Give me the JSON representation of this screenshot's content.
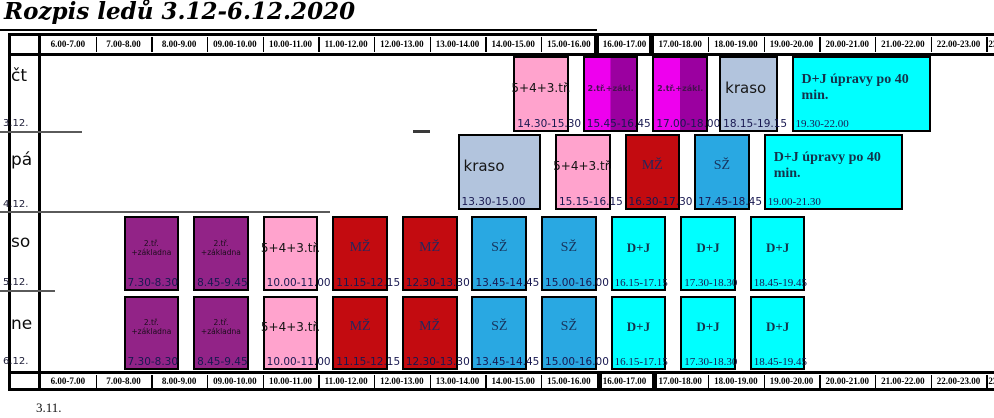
{
  "title": "Rozpis ledů 3.12-6.12.2020",
  "footnote": "3.11.",
  "time_columns": [
    "6.00-7.00",
    "7.00-8.00",
    "8.00-9.00",
    "09.00-10.00",
    "10.00-11.00",
    "11.00-12.00",
    "12.00-13.00",
    "13.00-14.00",
    "14.00-15.00",
    "15.00-16.00",
    "16.00-17.00",
    "17.00-18.00",
    "18.00-19.00",
    "19.00-20.00",
    "20.00-21.00",
    "21.00-22.00",
    "22.00-23.00",
    "23.00-24.00"
  ],
  "rows": [
    {
      "day": "čt",
      "date": "3.12."
    },
    {
      "day": "pá",
      "date": "4.12."
    },
    {
      "day": "so",
      "date": "5.12."
    },
    {
      "day": "ne",
      "date": "6.12."
    }
  ],
  "colors": {
    "pink": "#ffa3cd",
    "magenta": "#ee00ee",
    "dark_magenta": "#9b00a0",
    "purple": "#922387",
    "red": "#c30b10",
    "blue": "#29a8e2",
    "cyan": "#00ffff",
    "kraso": "#b2c4dd"
  },
  "blocks": [
    {
      "row": 0,
      "label": "5+4+3.tř.",
      "time": "14.30-15.30",
      "start": 14.5,
      "end": 15.5,
      "color": "pink"
    },
    {
      "row": 0,
      "label": "2.tř.+zákl.",
      "time": "15.45-16.45",
      "start": 15.75,
      "end": 16.75,
      "color": "magenta_split"
    },
    {
      "row": 0,
      "label": "2.tř.+zákl.",
      "time": "17.00-18.00",
      "start": 17.0,
      "end": 18.0,
      "color": "magenta_split"
    },
    {
      "row": 0,
      "label": "kraso",
      "time": "18.15-19.15",
      "start": 18.2,
      "end": 19.25,
      "color": "kraso"
    },
    {
      "row": 0,
      "label": "D+J úpravy po 40 min.",
      "time": "19.30-22.00",
      "start": 19.5,
      "end": 22.0,
      "color": "cyan"
    },
    {
      "row": 1,
      "label": "kraso",
      "time": "13.30-15.00",
      "start": 13.5,
      "end": 15.0,
      "color": "kraso"
    },
    {
      "row": 1,
      "label": "5+4+3.tř.",
      "time": "15.15-16.15",
      "start": 15.25,
      "end": 16.25,
      "color": "pink"
    },
    {
      "row": 1,
      "label": "MŽ",
      "time": "16.30-17.30",
      "start": 16.5,
      "end": 17.5,
      "color": "red"
    },
    {
      "row": 1,
      "label": "SŽ",
      "time": "17.45-18.45",
      "start": 17.75,
      "end": 18.75,
      "color": "blue"
    },
    {
      "row": 1,
      "label": "D+J úpravy po 40 min.",
      "time": "19.00-21.30",
      "start": 19.0,
      "end": 21.5,
      "color": "cyan"
    },
    {
      "row": 2,
      "label": "2.tř. +základna",
      "time": "7.30-8.30",
      "start": 7.5,
      "end": 8.5,
      "color": "purple"
    },
    {
      "row": 2,
      "label": "2.tř. +základna",
      "time": "8.45-9.45",
      "start": 8.75,
      "end": 9.75,
      "color": "purple"
    },
    {
      "row": 2,
      "label": "5+4+3.tř.",
      "time": "10.00-11.00",
      "start": 10.0,
      "end": 11.0,
      "color": "pink"
    },
    {
      "row": 2,
      "label": "MŽ",
      "time": "11.15-12.15",
      "start": 11.25,
      "end": 12.25,
      "color": "red"
    },
    {
      "row": 2,
      "label": "MŽ",
      "time": "12.30-13.30",
      "start": 12.5,
      "end": 13.5,
      "color": "red"
    },
    {
      "row": 2,
      "label": "SŽ",
      "time": "13.45-14.45",
      "start": 13.75,
      "end": 14.75,
      "color": "blue"
    },
    {
      "row": 2,
      "label": "SŽ",
      "time": "15.00-16.00",
      "start": 15.0,
      "end": 16.0,
      "color": "blue"
    },
    {
      "row": 2,
      "label": "D+J",
      "time": "16.15-17.15",
      "start": 16.25,
      "end": 17.25,
      "color": "cyan"
    },
    {
      "row": 2,
      "label": "D+J",
      "time": "17.30-18.30",
      "start": 17.5,
      "end": 18.5,
      "color": "cyan"
    },
    {
      "row": 2,
      "label": "D+J",
      "time": "18.45-19.45",
      "start": 18.75,
      "end": 19.75,
      "color": "cyan"
    },
    {
      "row": 3,
      "label": "2.tř. +základna",
      "time": "7.30-8.30",
      "start": 7.5,
      "end": 8.5,
      "color": "purple"
    },
    {
      "row": 3,
      "label": "2.tř. +základna",
      "time": "8.45-9.45",
      "start": 8.75,
      "end": 9.75,
      "color": "purple"
    },
    {
      "row": 3,
      "label": "5+4+3.tř.",
      "time": "10.00-11.00",
      "start": 10.0,
      "end": 11.0,
      "color": "pink"
    },
    {
      "row": 3,
      "label": "MŽ",
      "time": "11.15-12.15",
      "start": 11.25,
      "end": 12.25,
      "color": "red"
    },
    {
      "row": 3,
      "label": "MŽ",
      "time": "12.30-13.30",
      "start": 12.5,
      "end": 13.5,
      "color": "red"
    },
    {
      "row": 3,
      "label": "SŽ",
      "time": "13.45-14.45",
      "start": 13.75,
      "end": 14.75,
      "color": "blue"
    },
    {
      "row": 3,
      "label": "SŽ",
      "time": "15.00-16.00",
      "start": 15.0,
      "end": 16.0,
      "color": "blue"
    },
    {
      "row": 3,
      "label": "D+J",
      "time": "16.15-17.15",
      "start": 16.25,
      "end": 17.25,
      "color": "cyan"
    },
    {
      "row": 3,
      "label": "D+J",
      "time": "17.30-18.30",
      "start": 17.5,
      "end": 18.5,
      "color": "cyan"
    },
    {
      "row": 3,
      "label": "D+J",
      "time": "18.45-19.45",
      "start": 18.75,
      "end": 19.75,
      "color": "cyan"
    }
  ]
}
